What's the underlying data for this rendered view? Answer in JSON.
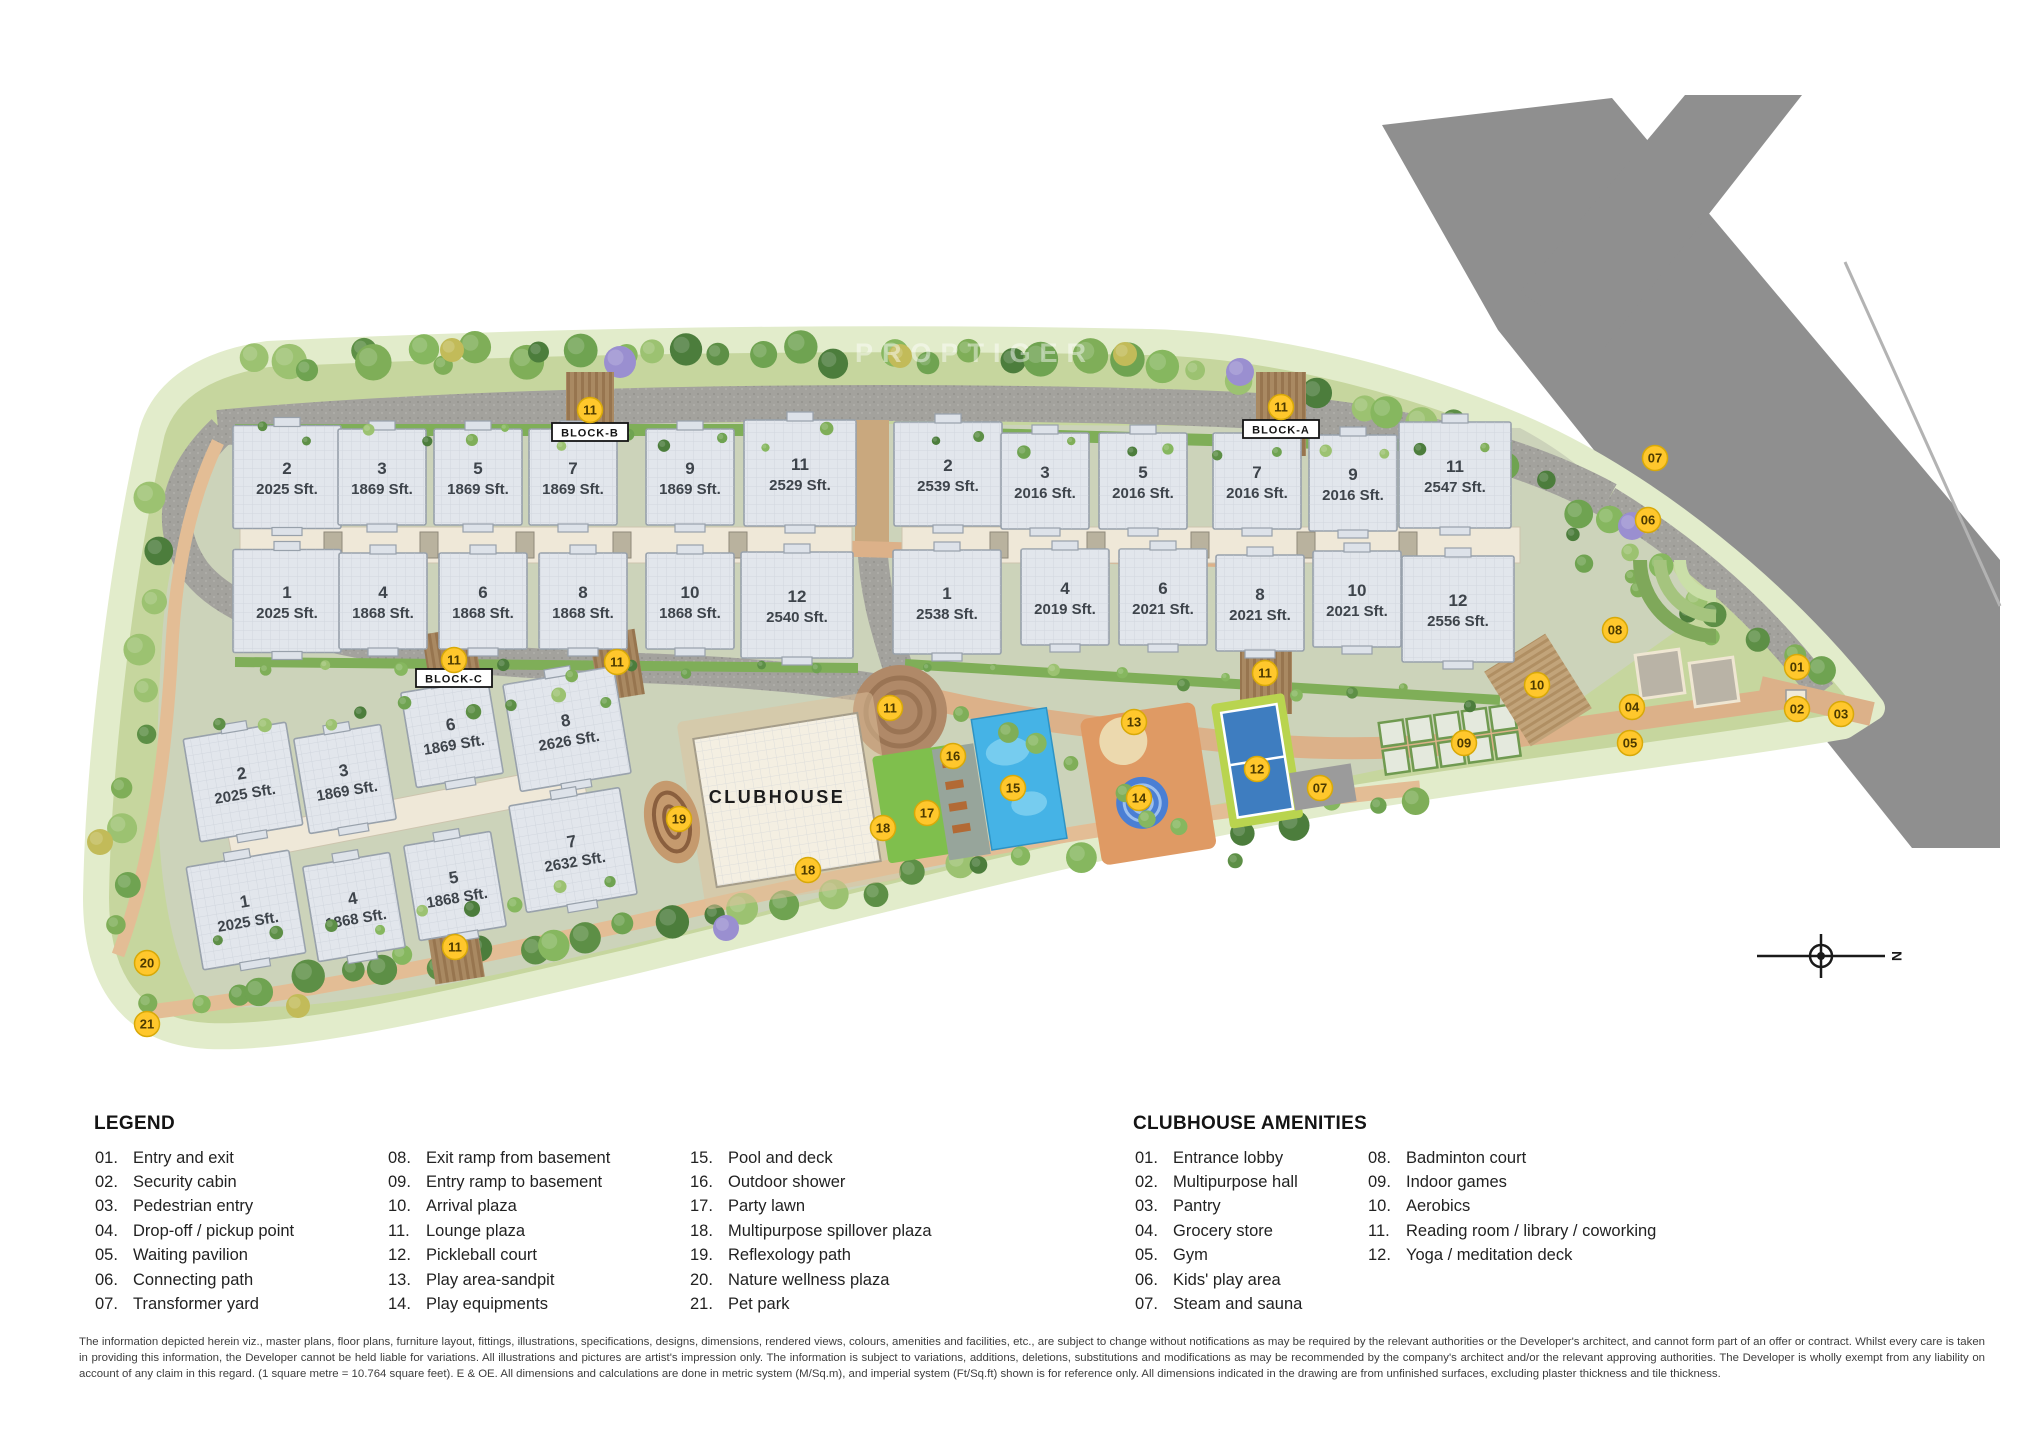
{
  "watermark": "PROPTIGER",
  "site": {
    "clubhouse_label": "CLUBHOUSE",
    "compass_label": "N",
    "block_signs": [
      {
        "label": "BLOCK-B",
        "x": 590,
        "y": 432
      },
      {
        "label": "BLOCK-A",
        "x": 1281,
        "y": 429
      },
      {
        "label": "BLOCK-C",
        "x": 454,
        "y": 678
      }
    ],
    "blocks": {
      "block_b": {
        "name": "BLOCK-B",
        "buildings": [
          {
            "id": "2",
            "area": "2025 Sft.",
            "cx": 287,
            "cy": 477,
            "w": 108,
            "h": 103
          },
          {
            "id": "3",
            "area": "1869 Sft.",
            "cx": 382,
            "cy": 477,
            "w": 88,
            "h": 96
          },
          {
            "id": "5",
            "area": "1869 Sft.",
            "cx": 478,
            "cy": 477,
            "w": 88,
            "h": 96
          },
          {
            "id": "7",
            "area": "1869 Sft.",
            "cx": 573,
            "cy": 477,
            "w": 88,
            "h": 96
          },
          {
            "id": "9",
            "area": "1869 Sft.",
            "cx": 690,
            "cy": 477,
            "w": 88,
            "h": 96
          },
          {
            "id": "11",
            "area": "2529 Sft.",
            "cx": 800,
            "cy": 473,
            "w": 112,
            "h": 106
          },
          {
            "id": "1",
            "area": "2025 Sft.",
            "cx": 287,
            "cy": 601,
            "w": 108,
            "h": 103
          },
          {
            "id": "4",
            "area": "1868 Sft.",
            "cx": 383,
            "cy": 601,
            "w": 88,
            "h": 96
          },
          {
            "id": "6",
            "area": "1868 Sft.",
            "cx": 483,
            "cy": 601,
            "w": 88,
            "h": 96
          },
          {
            "id": "8",
            "area": "1868 Sft.",
            "cx": 583,
            "cy": 601,
            "w": 88,
            "h": 96
          },
          {
            "id": "10",
            "area": "1868 Sft.",
            "cx": 690,
            "cy": 601,
            "w": 88,
            "h": 96
          },
          {
            "id": "12",
            "area": "2540 Sft.",
            "cx": 797,
            "cy": 605,
            "w": 112,
            "h": 106
          }
        ]
      },
      "block_a": {
        "name": "BLOCK-A",
        "buildings": [
          {
            "id": "2",
            "area": "2539 Sft.",
            "cx": 948,
            "cy": 474,
            "w": 108,
            "h": 104
          },
          {
            "id": "3",
            "area": "2016 Sft.",
            "cx": 1045,
            "cy": 481,
            "w": 88,
            "h": 96
          },
          {
            "id": "5",
            "area": "2016 Sft.",
            "cx": 1143,
            "cy": 481,
            "w": 88,
            "h": 96
          },
          {
            "id": "7",
            "area": "2016 Sft.",
            "cx": 1257,
            "cy": 481,
            "w": 88,
            "h": 96
          },
          {
            "id": "9",
            "area": "2016 Sft.",
            "cx": 1353,
            "cy": 483,
            "w": 88,
            "h": 96
          },
          {
            "id": "11",
            "area": "2547 Sft.",
            "cx": 1455,
            "cy": 475,
            "w": 112,
            "h": 106
          },
          {
            "id": "1",
            "area": "2538 Sft.",
            "cx": 947,
            "cy": 602,
            "w": 108,
            "h": 104
          },
          {
            "id": "4",
            "area": "2019 Sft.",
            "cx": 1065,
            "cy": 597,
            "w": 88,
            "h": 96
          },
          {
            "id": "6",
            "area": "2021 Sft.",
            "cx": 1163,
            "cy": 597,
            "w": 88,
            "h": 96
          },
          {
            "id": "8",
            "area": "2021 Sft.",
            "cx": 1260,
            "cy": 603,
            "w": 88,
            "h": 96
          },
          {
            "id": "10",
            "area": "2021 Sft.",
            "cx": 1357,
            "cy": 599,
            "w": 88,
            "h": 96
          },
          {
            "id": "12",
            "area": "2556 Sft.",
            "cx": 1458,
            "cy": 609,
            "w": 112,
            "h": 106
          }
        ]
      },
      "block_c": {
        "name": "BLOCK-C",
        "buildings": [
          {
            "id": "2",
            "area": "2025 Sft.",
            "cx": 243,
            "cy": 782,
            "w": 104,
            "h": 104,
            "rot": -9.5
          },
          {
            "id": "3",
            "area": "1869 Sft.",
            "cx": 345,
            "cy": 779,
            "w": 88,
            "h": 96,
            "rot": -9.5
          },
          {
            "id": "6",
            "area": "1869 Sft.",
            "cx": 452,
            "cy": 733,
            "w": 88,
            "h": 96,
            "rot": -9.5
          },
          {
            "id": "8",
            "area": "2626 Sft.",
            "cx": 567,
            "cy": 729,
            "w": 112,
            "h": 108,
            "rot": -9.5
          },
          {
            "id": "1",
            "area": "2025 Sft.",
            "cx": 246,
            "cy": 910,
            "w": 104,
            "h": 104,
            "rot": -9.5
          },
          {
            "id": "4",
            "area": "1868 Sft.",
            "cx": 354,
            "cy": 907,
            "w": 88,
            "h": 96,
            "rot": -9.5
          },
          {
            "id": "5",
            "area": "1868 Sft.",
            "cx": 455,
            "cy": 886,
            "w": 88,
            "h": 96,
            "rot": -9.5
          },
          {
            "id": "7",
            "area": "2632 Sft.",
            "cx": 573,
            "cy": 850,
            "w": 112,
            "h": 108,
            "rot": -9.5
          }
        ]
      }
    },
    "markers": [
      {
        "n": "11",
        "x": 590,
        "y": 410
      },
      {
        "n": "11",
        "x": 1281,
        "y": 407
      },
      {
        "n": "11",
        "x": 454,
        "y": 660
      },
      {
        "n": "11",
        "x": 617,
        "y": 662
      },
      {
        "n": "11",
        "x": 890,
        "y": 708
      },
      {
        "n": "11",
        "x": 1265,
        "y": 673
      },
      {
        "n": "11",
        "x": 455,
        "y": 947
      },
      {
        "n": "13",
        "x": 1134,
        "y": 722
      },
      {
        "n": "14",
        "x": 1139,
        "y": 798
      },
      {
        "n": "15",
        "x": 1013,
        "y": 788
      },
      {
        "n": "16",
        "x": 953,
        "y": 756
      },
      {
        "n": "17",
        "x": 927,
        "y": 813
      },
      {
        "n": "18",
        "x": 883,
        "y": 828
      },
      {
        "n": "18",
        "x": 808,
        "y": 870
      },
      {
        "n": "19",
        "x": 679,
        "y": 819
      },
      {
        "n": "12",
        "x": 1257,
        "y": 769
      },
      {
        "n": "07",
        "x": 1320,
        "y": 788
      },
      {
        "n": "09",
        "x": 1464,
        "y": 743
      },
      {
        "n": "10",
        "x": 1537,
        "y": 685
      },
      {
        "n": "08",
        "x": 1615,
        "y": 630
      },
      {
        "n": "06",
        "x": 1648,
        "y": 520
      },
      {
        "n": "07",
        "x": 1655,
        "y": 458
      },
      {
        "n": "04",
        "x": 1632,
        "y": 707
      },
      {
        "n": "05",
        "x": 1630,
        "y": 743
      },
      {
        "n": "01",
        "x": 1797,
        "y": 667
      },
      {
        "n": "02",
        "x": 1797,
        "y": 709
      },
      {
        "n": "03",
        "x": 1841,
        "y": 714
      },
      {
        "n": "20",
        "x": 147,
        "y": 963
      },
      {
        "n": "21",
        "x": 147,
        "y": 1024
      }
    ]
  },
  "legend": {
    "title": "LEGEND",
    "columns": [
      [
        {
          "num": "01.",
          "label": "Entry and exit"
        },
        {
          "num": "02.",
          "label": "Security cabin"
        },
        {
          "num": "03.",
          "label": "Pedestrian entry"
        },
        {
          "num": "04.",
          "label": "Drop-off / pickup point"
        },
        {
          "num": "05.",
          "label": "Waiting pavilion"
        },
        {
          "num": "06.",
          "label": "Connecting path"
        },
        {
          "num": "07.",
          "label": "Transformer yard"
        }
      ],
      [
        {
          "num": "08.",
          "label": "Exit ramp from basement"
        },
        {
          "num": "09.",
          "label": "Entry ramp to basement"
        },
        {
          "num": "10.",
          "label": "Arrival plaza"
        },
        {
          "num": "11.",
          "label": "Lounge plaza"
        },
        {
          "num": "12.",
          "label": "Pickleball court"
        },
        {
          "num": "13.",
          "label": "Play area-sandpit"
        },
        {
          "num": "14.",
          "label": "Play equipments"
        }
      ],
      [
        {
          "num": "15.",
          "label": "Pool and deck"
        },
        {
          "num": "16.",
          "label": "Outdoor shower"
        },
        {
          "num": "17.",
          "label": "Party lawn"
        },
        {
          "num": "18.",
          "label": "Multipurpose spillover plaza"
        },
        {
          "num": "19.",
          "label": "Reflexology path"
        },
        {
          "num": "20.",
          "label": "Nature wellness plaza"
        },
        {
          "num": "21.",
          "label": "Pet park"
        }
      ]
    ]
  },
  "clubhouse_amenities": {
    "title": "CLUBHOUSE AMENITIES",
    "columns": [
      [
        {
          "num": "01.",
          "label": "Entrance lobby"
        },
        {
          "num": "02.",
          "label": "Multipurpose hall"
        },
        {
          "num": "03.",
          "label": "Pantry"
        },
        {
          "num": "04.",
          "label": "Grocery store"
        },
        {
          "num": "05.",
          "label": "Gym"
        },
        {
          "num": "06.",
          "label": "Kids' play area"
        },
        {
          "num": "07.",
          "label": "Steam and sauna"
        }
      ],
      [
        {
          "num": "08.",
          "label": "Badminton court"
        },
        {
          "num": "09.",
          "label": "Indoor games"
        },
        {
          "num": "10.",
          "label": "Aerobics"
        },
        {
          "num": "11.",
          "label": "Reading room / library / coworking"
        },
        {
          "num": "12.",
          "label": "Yoga / meditation deck"
        }
      ]
    ]
  },
  "disclaimer": {
    "text": "The information depicted herein viz., master plans, floor plans, furniture layout, fittings, illustrations, specifications, designs, dimensions, rendered views, colours, amenities and facilities, etc., are subject to change without notifications as may be required by the relevant authorities or the Developer's architect, and cannot form part of an offer or contract. Whilst every care is taken in providing this information, the Developer cannot be held liable for variations. All illustrations and pictures are artist's impression only. The information is subject to variations, additions, deletions, substitutions and modifications as may be recommended by the company's architect and/or the relevant approving authorities. The Developer is wholly exempt from any liability on account of any claim in this regard. (1 square metre = 10.764 square feet). E & OE. All dimensions and calculations are done in metric system (M/Sq.m), and imperial system (Ft/Sq.ft) shown is for reference only. All dimensions indicated in the drawing are from unfinished surfaces, excluding plaster thickness and tile thickness."
  }
}
